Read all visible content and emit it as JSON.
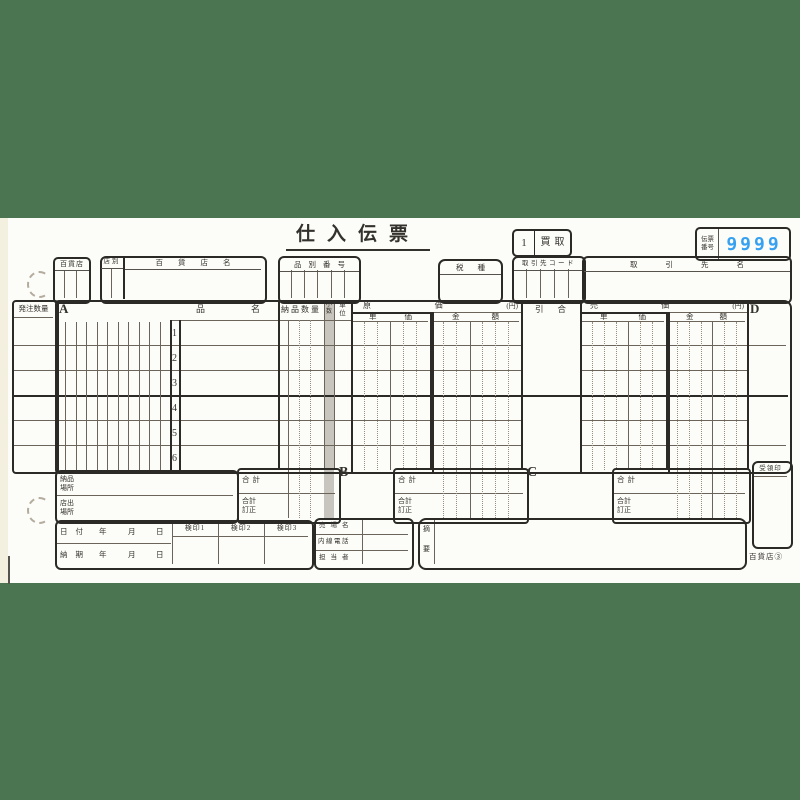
{
  "colors": {
    "band_green": "#4b7451",
    "paper": "#fcfcf8",
    "slip_number_blue": "#37a1f1",
    "shaded_column_gray": "#c8c5be",
    "line_dark": "#2b2a27"
  },
  "title": "仕入伝票",
  "header": {
    "type_code": "1",
    "type_label": "買取",
    "slip_no_label1": "伝票",
    "slip_no_label2": "番号",
    "slip_no": "9999",
    "store": "百貨店",
    "store_branch": "店別",
    "store_name": "百貨店名",
    "item_no": "品別番号",
    "tax": "税種",
    "vendor_code": "取引先コード",
    "vendor_name": "取引先名"
  },
  "grid": {
    "order_qty": "発注数量",
    "sec_a": "A",
    "sec_d": "D",
    "item1": "品",
    "item2": "名",
    "delivery_qty": "納品数量",
    "dec1": "小",
    "dec2": "数",
    "unit1": "単",
    "unit2": "位",
    "cost1": "原",
    "cost2": "価",
    "yen": "(円)",
    "price1": "売",
    "price2": "価",
    "unitprice1": "単",
    "unitprice2": "価",
    "amount1": "金",
    "amount2": "額",
    "nego1": "引",
    "nego2": "合",
    "rows": [
      "1",
      "2",
      "3",
      "4",
      "5",
      "6"
    ]
  },
  "totals": {
    "total": "合計",
    "fix1": "合計",
    "fix2": "訂正",
    "sec_b": "B",
    "sec_c": "C",
    "receipt_stamp": "受領印"
  },
  "footer": {
    "deliv_place1": "納品",
    "deliv_place2": "場所",
    "ship_place1": "店出",
    "ship_place2": "場所",
    "date": "日付",
    "due": "納期",
    "year": "年",
    "month": "月",
    "day": "日",
    "stamp1": "検印1",
    "stamp2": "検印2",
    "stamp3": "検印3",
    "floor": "売場名",
    "ext_tel": "内線電話",
    "person": "担当者",
    "note1": "摘",
    "note2": "要",
    "page": "百貨店③"
  }
}
